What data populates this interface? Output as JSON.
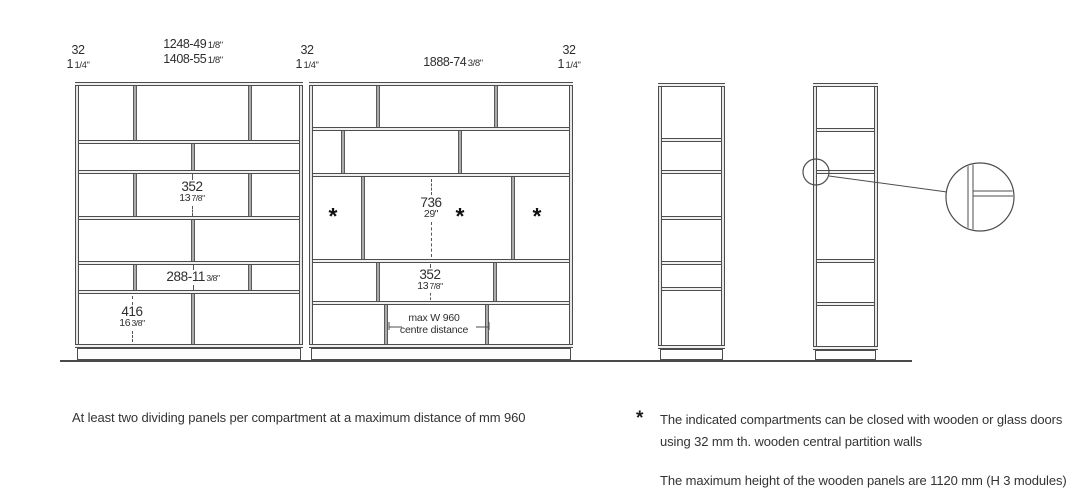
{
  "colors": {
    "line": "#4d4d4d",
    "text": "#2e2e2e",
    "divider_fill": "#ababab",
    "shelf_fill": "#f0f0f0"
  },
  "top_dimensions": [
    {
      "x": 78,
      "y": 44,
      "lines": [
        {
          "main": "32",
          "frac": ""
        },
        {
          "main": "1",
          "frac": "1/4\""
        }
      ]
    },
    {
      "x": 193,
      "y": 38,
      "lines": [
        {
          "main": "1248-49",
          "frac": "1/8\""
        },
        {
          "main": "1408-55",
          "frac": "1/8\""
        }
      ]
    },
    {
      "x": 307,
      "y": 44,
      "lines": [
        {
          "main": "32",
          "frac": ""
        },
        {
          "main": "1",
          "frac": "1/4\""
        }
      ]
    },
    {
      "x": 453,
      "y": 56,
      "lines": [
        {
          "main": "1888-74",
          "frac": "3/8\""
        }
      ]
    },
    {
      "x": 569,
      "y": 44,
      "lines": [
        {
          "main": "32",
          "frac": ""
        },
        {
          "main": "1",
          "frac": "1/4\""
        }
      ]
    }
  ],
  "units": [
    {
      "name": "front-unit-left",
      "x": 75,
      "y": 82,
      "w": 228,
      "rows": [
        {
          "h": 54,
          "dividers": [
            0.255,
            0.775
          ]
        },
        {
          "h": 26,
          "dividers": [
            0.518
          ]
        },
        {
          "h": 42,
          "dividers": [
            0.255,
            0.775
          ]
        },
        {
          "h": 41,
          "dividers": [
            0.518
          ]
        },
        {
          "h": 25,
          "dividers": [
            0.255,
            0.775
          ]
        },
        {
          "h": 50,
          "dividers": [
            0.518
          ]
        }
      ],
      "plinth": {
        "h": 12,
        "inset": 2
      }
    },
    {
      "name": "front-unit-right",
      "x": 309,
      "y": 82,
      "w": 264,
      "rows": [
        {
          "h": 41,
          "dividers": [
            0.254,
            0.715
          ]
        },
        {
          "h": 42,
          "dividers": [
            0.117,
            0.574
          ]
        },
        {
          "h": 82,
          "dividers": [
            0.195,
            0.781
          ]
        },
        {
          "h": 38,
          "dividers": [
            0.254,
            0.711
          ]
        },
        {
          "h": 39,
          "dividers": [
            0.285,
            0.68
          ]
        }
      ],
      "plinth": {
        "h": 12,
        "inset": 2
      }
    },
    {
      "name": "side-unit-1",
      "x": 658,
      "y": 83,
      "w": 67,
      "rows": [
        {
          "h": 51
        },
        {
          "h": 28
        },
        {
          "h": 42
        },
        {
          "h": 41
        },
        {
          "h": 22
        },
        {
          "h": 54
        }
      ],
      "plinth": {
        "h": 11,
        "inset": 2
      }
    },
    {
      "name": "side-unit-2",
      "x": 813,
      "y": 83,
      "w": 65,
      "rows": [
        {
          "h": 41
        },
        {
          "h": 38
        },
        {
          "h": 85
        },
        {
          "h": 39
        },
        {
          "h": 40
        }
      ],
      "plinth": {
        "h": 10,
        "inset": 2
      }
    }
  ],
  "dim_labels": [
    {
      "name": "dim-352-left",
      "x": 192,
      "y": 180,
      "small": false,
      "lines": [
        {
          "main": "352",
          "frac": ""
        },
        {
          "main": "13",
          "frac": "7/8\""
        }
      ],
      "dash": {
        "x": 192,
        "segs": [
          [
            174,
            180
          ],
          [
            206,
            216
          ]
        ]
      }
    },
    {
      "name": "dim-288",
      "x": 193,
      "y": 270,
      "small": false,
      "lines": [
        {
          "main": "288-11",
          "frac": "3/8\""
        }
      ],
      "dash": {
        "x": 193,
        "segs": [
          [
            265,
            270
          ],
          [
            284,
            290
          ]
        ]
      }
    },
    {
      "name": "dim-416",
      "x": 132,
      "y": 305,
      "small": false,
      "lines": [
        {
          "main": "416",
          "frac": ""
        },
        {
          "main": "16",
          "frac": "3/8\""
        }
      ],
      "dash": {
        "x": 132,
        "segs": [
          [
            296,
            305
          ],
          [
            331,
            342
          ]
        ]
      }
    },
    {
      "name": "dim-736",
      "x": 431,
      "y": 196,
      "small": false,
      "lines": [
        {
          "main": "736",
          "frac": ""
        },
        {
          "main": "29\"",
          "frac": ""
        }
      ],
      "dash": {
        "x": 431,
        "segs": [
          [
            179,
            195
          ],
          [
            222,
            257
          ]
        ]
      }
    },
    {
      "name": "dim-352-right",
      "x": 430,
      "y": 268,
      "small": false,
      "lines": [
        {
          "main": "352",
          "frac": ""
        },
        {
          "main": "13",
          "frac": "7/8\""
        }
      ],
      "dash": {
        "x": 430,
        "segs": [
          [
            264,
            268
          ],
          [
            293,
            300
          ]
        ]
      }
    },
    {
      "name": "label-max-w",
      "x": 434,
      "y": 313,
      "small": true,
      "lines": [
        {
          "main": "max W 960",
          "frac": ""
        },
        {
          "main": "centre distance",
          "frac": ""
        }
      ]
    }
  ],
  "asterisks": [
    {
      "x": 333,
      "y": 213
    },
    {
      "x": 460,
      "y": 213
    },
    {
      "x": 537,
      "y": 213
    }
  ],
  "max_w_ticks": [
    {
      "vline": [
        389,
        322,
        330
      ],
      "hline": [
        389,
        402,
        327
      ]
    },
    {
      "vline": [
        489,
        322,
        330
      ],
      "hline": [
        476,
        489,
        327
      ]
    }
  ],
  "detail": {
    "small_circle": {
      "cx": 816,
      "cy": 172,
      "r": 13
    },
    "leader": {
      "x1": 829,
      "y1": 176,
      "x2": 947,
      "y2": 192
    },
    "big_circle": {
      "cx": 980,
      "cy": 197,
      "r": 34
    },
    "joint": {
      "v1": 968,
      "v2": 973,
      "h1": 191,
      "h2": 196,
      "hx2": 1015,
      "vy1": 162,
      "vy2": 232
    }
  },
  "ground_line": {
    "x1": 60,
    "x2": 912,
    "y": 361
  },
  "notes": {
    "note1": "At least two dividing panels per compartment at a maximum distance of mm 960",
    "asterisk": "*",
    "note2_line1": "The indicated compartments can be closed with wooden or glass doors",
    "note2_line2": "using 32 mm th. wooden central partition walls",
    "note3": "The maximum height of the wooden panels are 1120 mm (H 3 modules)"
  }
}
